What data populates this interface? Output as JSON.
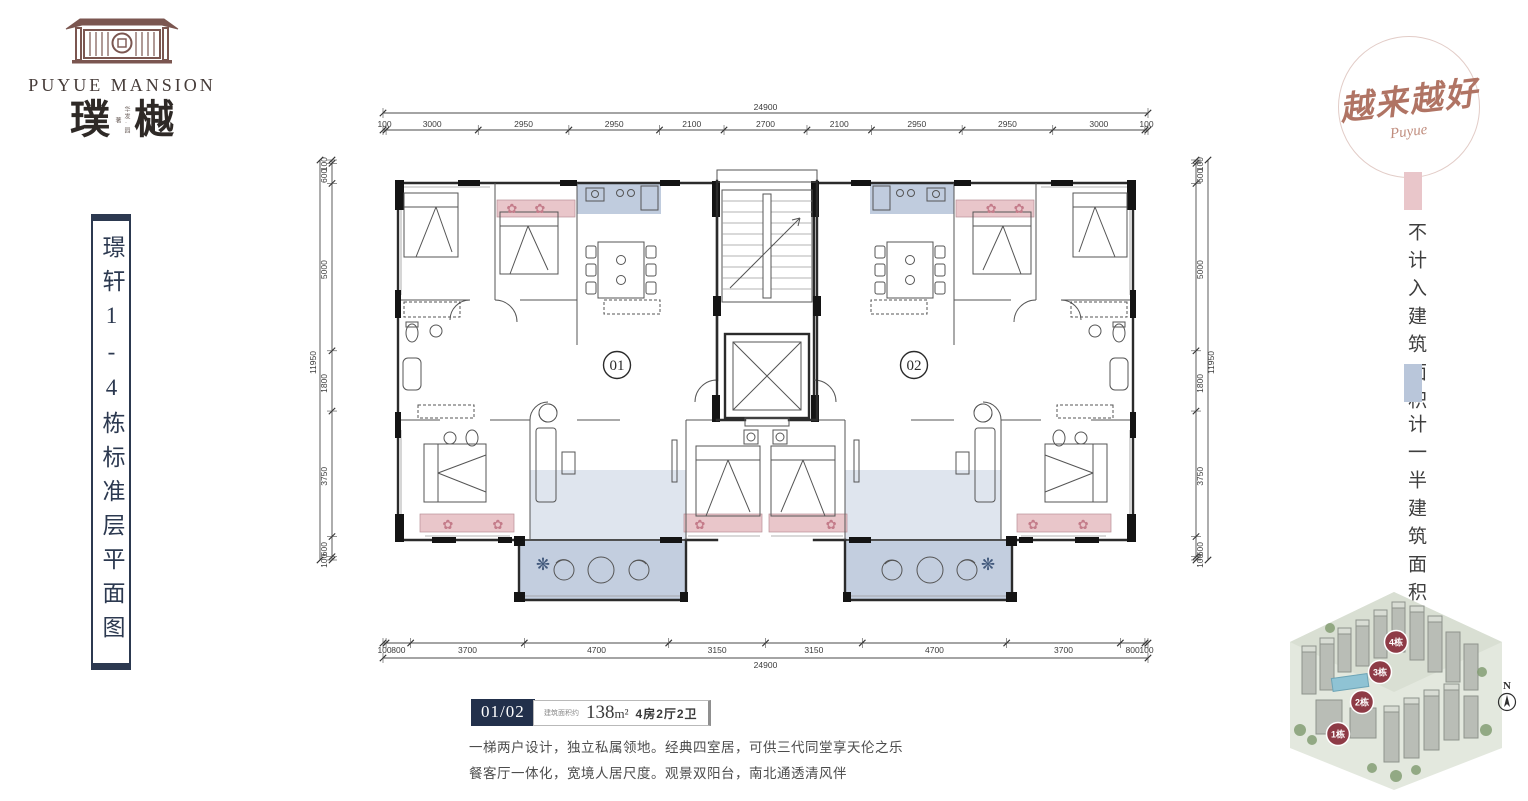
{
  "brand": {
    "name_en": "PUYUE MANSION",
    "cn_left": "璞",
    "cn_right": "樾",
    "cn_sub": "华发·园著",
    "accent_color": "#7b5650"
  },
  "side_plate": {
    "title": "璟轩1-4栋标准层平面图"
  },
  "stamp": {
    "text": "越来越好",
    "script": "Puyue",
    "color": "#b07464"
  },
  "legend": {
    "items": [
      {
        "label": "不计入建筑面积",
        "color": "#e9c6ca"
      },
      {
        "label": "计一半建筑面积",
        "color": "#b9c6da"
      }
    ]
  },
  "unit_info": {
    "badge": "01/02",
    "area_prefix": "建筑面积约",
    "area_value": "138",
    "area_unit": "m²",
    "layout": "4房2厅2卫",
    "desc_line1": "一梯两户设计，独立私属领地。经典四室居，可供三代同堂享天伦之乐",
    "desc_line2": "餐客厅一体化，宽境人居尺度。观景双阳台，南北通透清风伴",
    "badge_color": "#22304b"
  },
  "site_map": {
    "buildings": [
      "1栋",
      "2栋",
      "3栋",
      "4栋"
    ],
    "badge_color": "#8e3b46",
    "compass": "N"
  },
  "plan": {
    "units": [
      {
        "label": "01"
      },
      {
        "label": "02"
      }
    ],
    "colors": {
      "excluded_area": "#e9c6ca",
      "half_area": "#b9c6da",
      "wall": "#2b2b2b"
    },
    "dims": {
      "top_total": "24900",
      "top_segments": [
        "100",
        "3000",
        "2950",
        "2950",
        "2100",
        "2700",
        "2100",
        "2950",
        "2950",
        "3000",
        "100"
      ],
      "bottom_total": "24900",
      "bottom_segments": [
        "100",
        "800",
        "3700",
        "4700",
        "3150",
        "3150",
        "4700",
        "3700",
        "800",
        "100"
      ],
      "side_total": "11950",
      "side_segments": [
        "100",
        "600",
        "5000",
        "1800",
        "3750",
        "600",
        "100"
      ]
    }
  }
}
